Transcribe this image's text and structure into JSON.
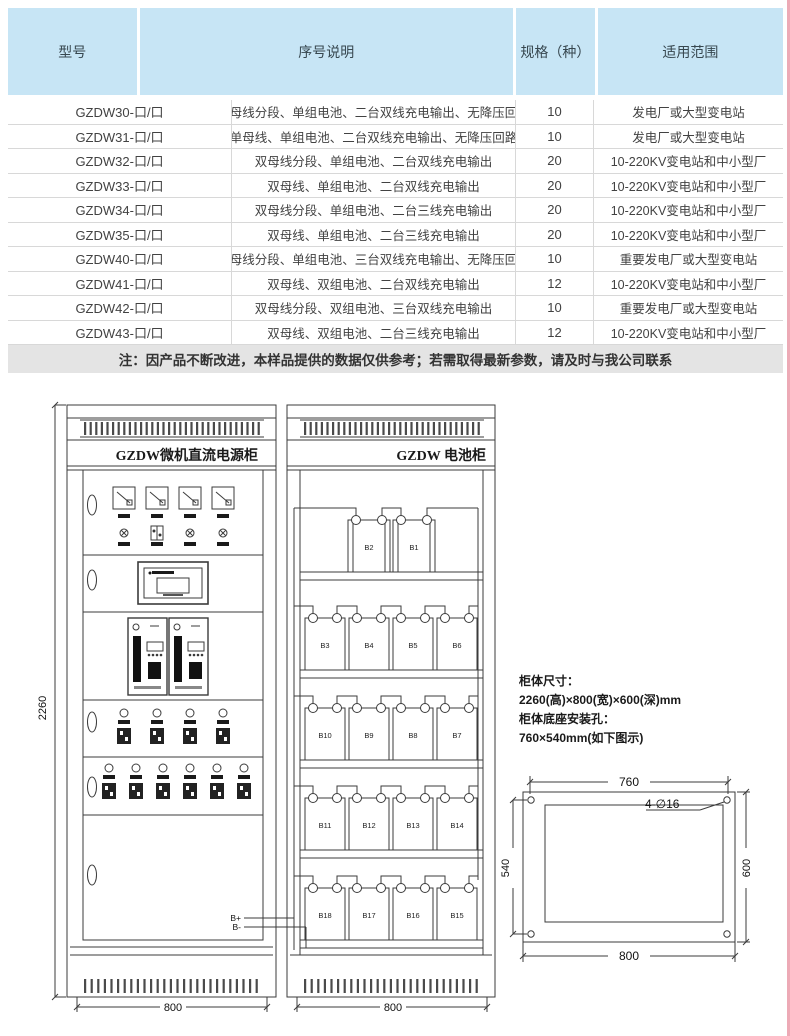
{
  "table": {
    "headers": [
      "型号",
      "序号说明",
      "规格（种）",
      "适用范围"
    ],
    "rows": [
      [
        "GZDW30-口/口",
        "单母线分段、单组电池、二台双线充电输出、无降压回路",
        "10",
        "发电厂或大型变电站"
      ],
      [
        "GZDW31-口/口",
        "单母线、单组电池、二台双线充电输出、无降压回路",
        "10",
        "发电厂或大型变电站"
      ],
      [
        "GZDW32-口/口",
        "双母线分段、单组电池、二台双线充电输出",
        "20",
        "10-220KV变电站和中小型厂"
      ],
      [
        "GZDW33-口/口",
        "双母线、单组电池、二台双线充电输出",
        "20",
        "10-220KV变电站和中小型厂"
      ],
      [
        "GZDW34-口/口",
        "双母线分段、单组电池、二台三线充电输出",
        "20",
        "10-220KV变电站和中小型厂"
      ],
      [
        "GZDW35-口/口",
        "双母线、单组电池、二台三线充电输出",
        "20",
        "10-220KV变电站和中小型厂"
      ],
      [
        "GZDW40-口/口",
        "单母线分段、单组电池、三台双线充电输出、无降压回路",
        "10",
        "重要发电厂或大型变电站"
      ],
      [
        "GZDW41-口/口",
        "双母线、双组电池、二台双线充电输出",
        "12",
        "10-220KV变电站和中小型厂"
      ],
      [
        "GZDW42-口/口",
        "双母线分段、双组电池、三台双线充电输出",
        "10",
        "重要发电厂或大型变电站"
      ],
      [
        "GZDW43-口/口",
        "双母线、双组电池、二台三线充电输出",
        "12",
        "10-220KV变电站和中小型厂"
      ]
    ]
  },
  "note": "注：因产品不断改进，本样品提供的数据仅供参考；若需取得最新参数，请及时与我公司联系",
  "diagram": {
    "power_cabinet_title": "GZDW微机直流电源柜",
    "battery_cabinet_title": "GZDW 电池柜",
    "labels": {
      "b_plus": "B+",
      "b_minus": "B-"
    },
    "dimensions": {
      "height": "2260",
      "power_width": "800",
      "battery_width": "800"
    },
    "battery_shelves": [
      [
        "B2",
        "B1"
      ],
      [
        "B3",
        "B4",
        "B5",
        "B6"
      ],
      [
        "B10",
        "B9",
        "B8",
        "B7"
      ],
      [
        "B11",
        "B12",
        "B13",
        "B14"
      ],
      [
        "B18",
        "B17",
        "B16",
        "B15"
      ]
    ],
    "spec_text": {
      "line1": "柜体尺寸：",
      "line2": "2260(高)×800(宽)×600(深)mm",
      "line3": "柜体底座安装孔：",
      "line4": "760×540mm(如下图示)"
    },
    "base_diagram": {
      "top": "760",
      "bottom": "800",
      "left": "540",
      "right": "600",
      "holes": "4-∅16"
    }
  },
  "colors": {
    "header_bg": "#c7e5f5",
    "note_bg": "#e4e4e4",
    "line": "#3b3b3b",
    "edge_accent": "#edaab6"
  }
}
